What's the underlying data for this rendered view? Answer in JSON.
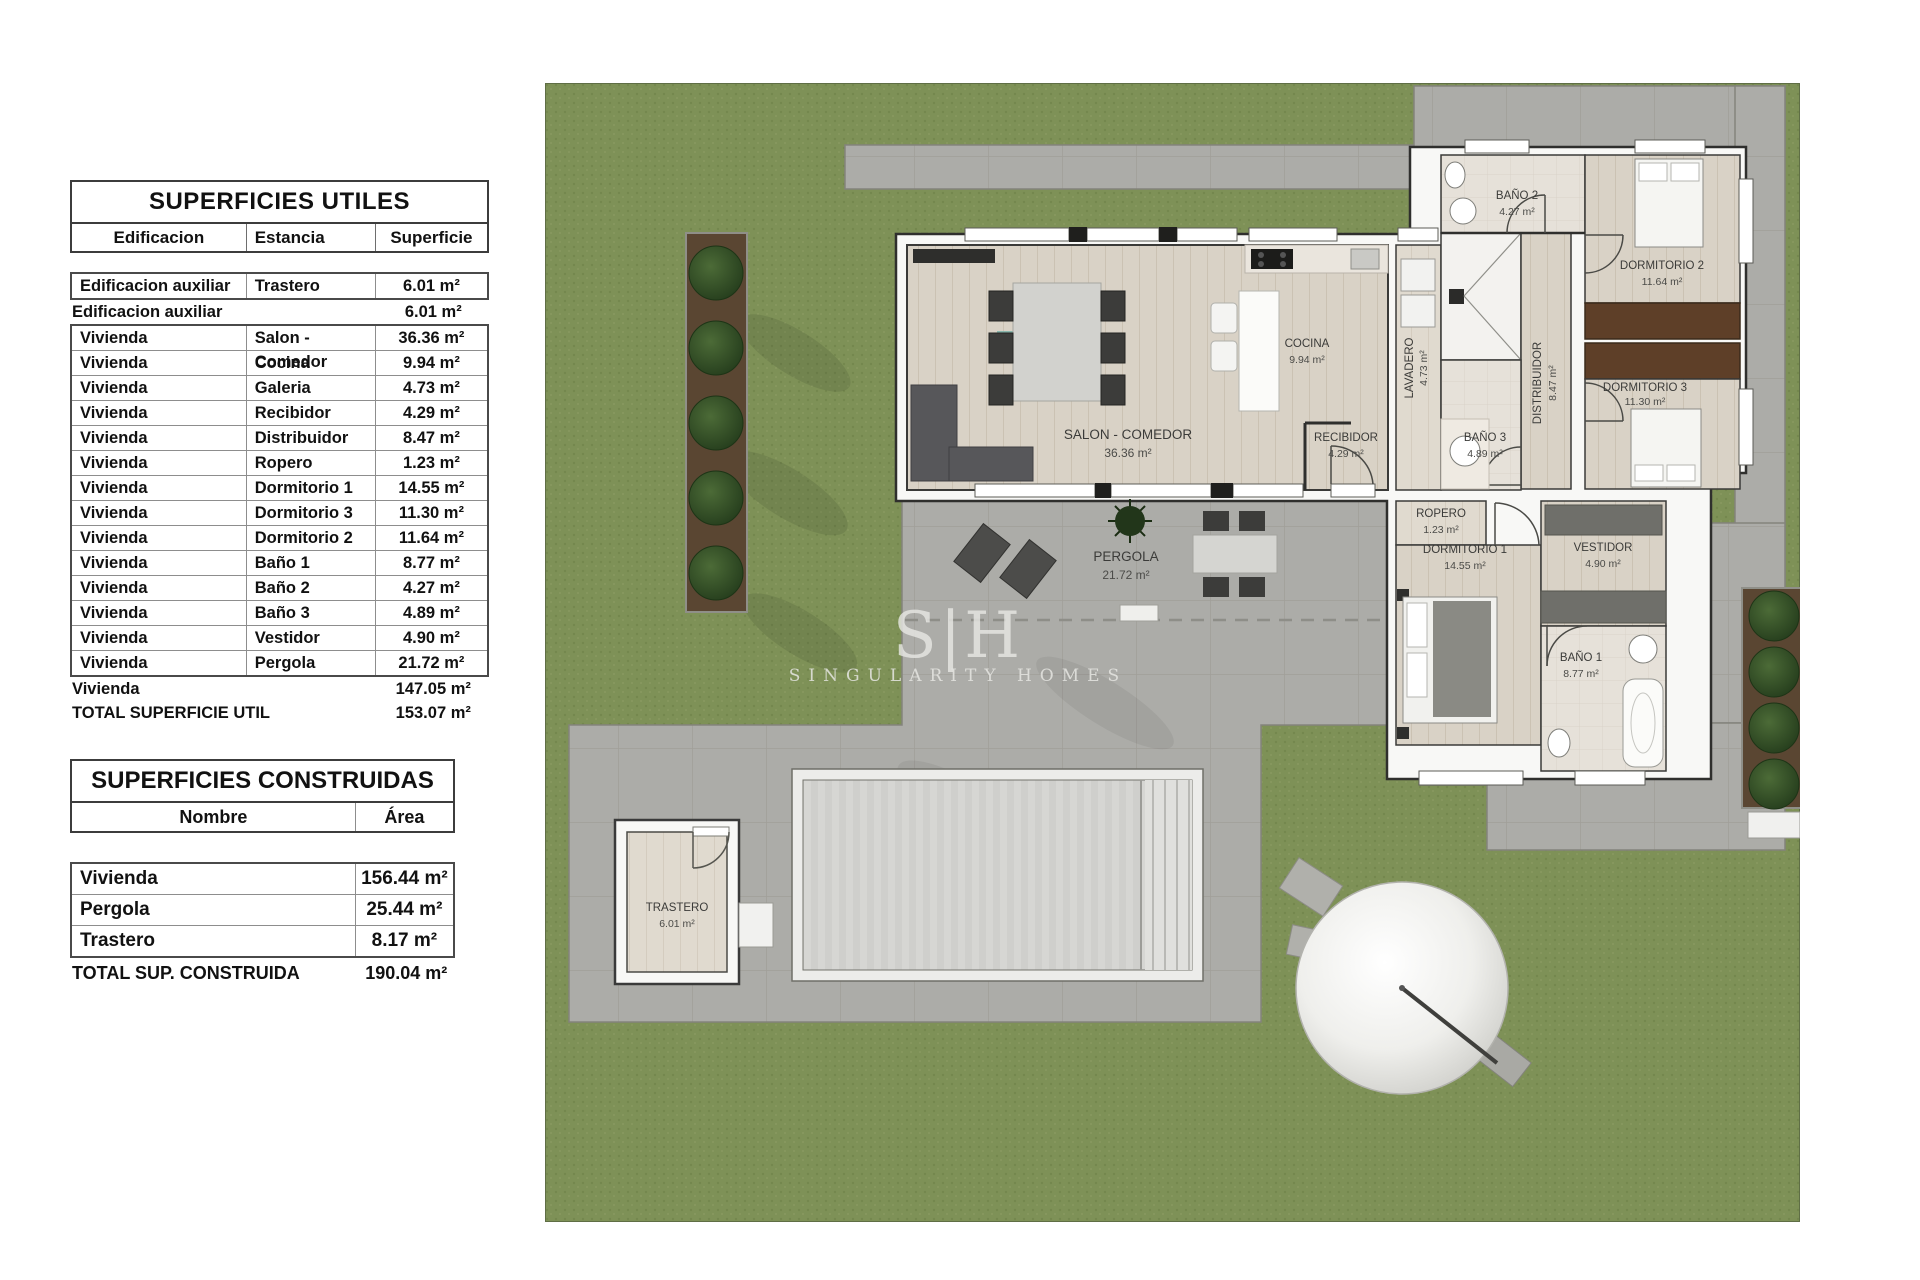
{
  "tables": {
    "utiles": {
      "title": "SUPERFICIES UTILES",
      "headers": {
        "edificacion": "Edificacion",
        "estancia": "Estancia",
        "superficie": "Superficie"
      },
      "trastero_row": {
        "edificacion": "Edificacion auxiliar",
        "estancia": "Trastero",
        "superficie": "6.01 m²"
      },
      "subtotal_row": {
        "label": "Edificacion auxiliar",
        "value": "6.01 m²"
      },
      "rows": [
        {
          "edificacion": "Vivienda",
          "estancia": "Salon - Comedor",
          "superficie": "36.36 m²"
        },
        {
          "edificacion": "Vivienda",
          "estancia": "Cocina",
          "superficie": "9.94 m²"
        },
        {
          "edificacion": "Vivienda",
          "estancia": "Galeria",
          "superficie": "4.73 m²"
        },
        {
          "edificacion": "Vivienda",
          "estancia": "Recibidor",
          "superficie": "4.29 m²"
        },
        {
          "edificacion": "Vivienda",
          "estancia": "Distribuidor",
          "superficie": "8.47 m²"
        },
        {
          "edificacion": "Vivienda",
          "estancia": "Ropero",
          "superficie": "1.23 m²"
        },
        {
          "edificacion": "Vivienda",
          "estancia": "Dormitorio 1",
          "superficie": "14.55 m²"
        },
        {
          "edificacion": "Vivienda",
          "estancia": "Dormitorio 3",
          "superficie": "11.30 m²"
        },
        {
          "edificacion": "Vivienda",
          "estancia": "Dormitorio 2",
          "superficie": "11.64 m²"
        },
        {
          "edificacion": "Vivienda",
          "estancia": "Baño 1",
          "superficie": "8.77 m²"
        },
        {
          "edificacion": "Vivienda",
          "estancia": "Baño 2",
          "superficie": "4.27 m²"
        },
        {
          "edificacion": "Vivienda",
          "estancia": "Baño 3",
          "superficie": "4.89 m²"
        },
        {
          "edificacion": "Vivienda",
          "estancia": "Vestidor",
          "superficie": "4.90 m²"
        },
        {
          "edificacion": "Vivienda",
          "estancia": "Pergola",
          "superficie": "21.72 m²"
        }
      ],
      "vivienda_total": {
        "label": "Vivienda",
        "value": "147.05 m²"
      },
      "total": {
        "label": "TOTAL SUPERFICIE UTIL",
        "value": "153.07 m²"
      }
    },
    "construidas": {
      "title": "SUPERFICIES CONSTRUIDAS",
      "headers": {
        "nombre": "Nombre",
        "area": "Área"
      },
      "rows": [
        {
          "nombre": "Vivienda",
          "area": "156.44 m²"
        },
        {
          "nombre": "Pergola",
          "area": "25.44 m²"
        },
        {
          "nombre": "Trastero",
          "area": "8.17 m²"
        }
      ],
      "total": {
        "label": "TOTAL SUP. CONSTRUIDA",
        "value": "190.04 m²"
      }
    }
  },
  "plan": {
    "watermark": {
      "logo": "S|H",
      "name": "SINGULARITY HOMES"
    },
    "rooms": [
      {
        "label": "SALON - COMEDOR",
        "area": "36.36 m²"
      },
      {
        "label": "COCINA",
        "area": "9.94 m²"
      },
      {
        "label": "LAVADERO",
        "area": "4.73 m²"
      },
      {
        "label": "BAÑO 2",
        "area": "4.27 m²"
      },
      {
        "label": "BAÑO 3",
        "area": "4.89 m²"
      },
      {
        "label": "DISTRIBUIDOR",
        "area": "8.47 m²"
      },
      {
        "label": "DORMITORIO 2",
        "area": "11.64 m²"
      },
      {
        "label": "DORMITORIO 3",
        "area": "11.30 m²"
      },
      {
        "label": "RECIBIDOR",
        "area": "4.29 m²"
      },
      {
        "label": "ROPERO",
        "area": "1.23 m²"
      },
      {
        "label": "DORMITORIO 1",
        "area": "14.55 m²"
      },
      {
        "label": "VESTIDOR",
        "area": "4.90 m²"
      },
      {
        "label": "BAÑO 1",
        "area": "8.77 m²"
      },
      {
        "label": "PERGOLA",
        "area": "21.72 m²"
      },
      {
        "label": "TRASTERO",
        "area": "6.01 m²"
      }
    ]
  },
  "colors": {
    "grass": "#7e9157",
    "paving": "#acaca8",
    "wood_floor": "#d9d2c6",
    "wall": "#f8f8f6",
    "tree": "#2e4a22",
    "pool_water": "#d6d6d3",
    "wardrobe_wood": "#5e3f28"
  }
}
